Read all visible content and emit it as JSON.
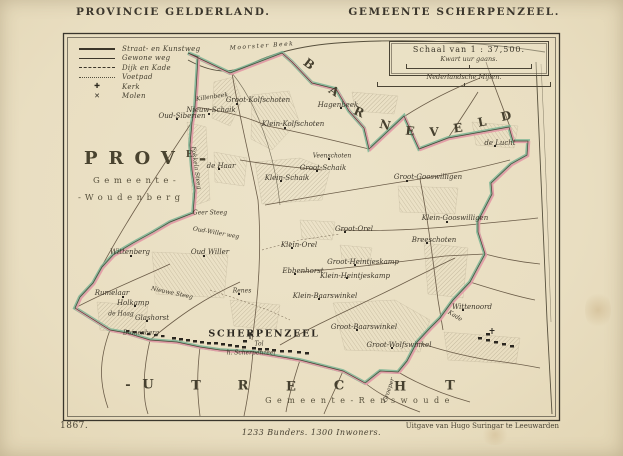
{
  "header": {
    "left_title": "PROVINCIE  GELDERLAND.",
    "right_title": "GEMEENTE  SCHERPENZEEL."
  },
  "legend": {
    "items": [
      {
        "label": "Straat- en Kunstweg"
      },
      {
        "label": "Gewone weg"
      },
      {
        "label": "Dijk en Kade"
      },
      {
        "label": "Voetpad"
      },
      {
        "label": "Kerk",
        "symbol": "✚"
      },
      {
        "label": "Molen",
        "symbol": "✕"
      }
    ],
    "kerk_symbol": "✚",
    "molen_symbol": "✕"
  },
  "scalebox": {
    "title": "Schaal van 1 : 37,500.",
    "kwart": "Kwart uur gaans.",
    "mijlen": "Nederlandsche Mijlen."
  },
  "footer": {
    "year": "1867.",
    "stats": "1233 Bunders. 1300 Inwoners.",
    "publisher": "Uitgave van Hugo Suringar te Leeuwarden"
  },
  "colors": {
    "paper": "#e9dec1",
    "boundary_green": "#7ab494",
    "boundary_pink": "#e59ca6",
    "ink": "#3c362a"
  },
  "map": {
    "province_left": {
      "abbr": "PROV",
      "sup": "E",
      "dash": "-",
      "line2": "Gemeente-",
      "line3": "-Woudenberg"
    },
    "renswoude": "Gemeente-Renswoude",
    "barneveld_letters": [
      {
        "c": "B",
        "x": 309,
        "y": 64,
        "r": 38
      },
      {
        "c": "A",
        "x": 334,
        "y": 91,
        "r": 33
      },
      {
        "c": "R",
        "x": 359,
        "y": 112,
        "r": 24
      },
      {
        "c": "N",
        "x": 385,
        "y": 125,
        "r": 14
      },
      {
        "c": "E",
        "x": 410,
        "y": 131,
        "r": 6
      },
      {
        "c": "V",
        "x": 434,
        "y": 132,
        "r": -2
      },
      {
        "c": "E",
        "x": 458,
        "y": 128,
        "r": -8
      },
      {
        "c": "L",
        "x": 482,
        "y": 122,
        "r": -11
      },
      {
        "c": "D",
        "x": 506,
        "y": 116,
        "r": -13
      }
    ],
    "utrecht_letters": [
      {
        "c": "-",
        "x": 128,
        "y": 385
      },
      {
        "c": "U",
        "x": 148,
        "y": 385
      },
      {
        "c": "T",
        "x": 196,
        "y": 386
      },
      {
        "c": "R",
        "x": 243,
        "y": 386
      },
      {
        "c": "E",
        "x": 291,
        "y": 387
      },
      {
        "c": "C",
        "x": 339,
        "y": 386
      },
      {
        "c": "H",
        "x": 400,
        "y": 387
      },
      {
        "c": "T",
        "x": 450,
        "y": 386
      }
    ],
    "labels": [
      {
        "t": "Moorster Beek",
        "x": 262,
        "y": 46,
        "s": 6,
        "ls": 1.5,
        "r": -4
      },
      {
        "t": "Killenbeek",
        "x": 212,
        "y": 97,
        "s": 6,
        "r": -8
      },
      {
        "t": "Groot-Kolfschoten",
        "x": 258,
        "y": 100
      },
      {
        "t": "Nieuw-Schaik",
        "x": 211,
        "y": 110
      },
      {
        "t": "Klein-Kolfschoten",
        "x": 293,
        "y": 124
      },
      {
        "t": "Oud-Siberien",
        "x": 182,
        "y": 116
      },
      {
        "t": "Hagenbeek",
        "x": 338,
        "y": 105
      },
      {
        "t": "de Lucht",
        "x": 500,
        "y": 143
      },
      {
        "t": "de Haar",
        "x": 221,
        "y": 166
      },
      {
        "t": "Fokkela Steeg",
        "x": 196,
        "y": 168,
        "s": 6,
        "r": 82
      },
      {
        "t": "Veenschoten",
        "x": 332,
        "y": 156,
        "s": 6
      },
      {
        "t": "Groot-Schaik",
        "x": 323,
        "y": 168
      },
      {
        "t": "Klein-Schaik",
        "x": 287,
        "y": 178
      },
      {
        "t": "Groot-Gooswilligen",
        "x": 428,
        "y": 177
      },
      {
        "t": "Klein-Gooswilligen",
        "x": 455,
        "y": 218
      },
      {
        "t": "Breeschoten",
        "x": 434,
        "y": 240
      },
      {
        "t": "Groot-Orel",
        "x": 354,
        "y": 229
      },
      {
        "t": "Klein-Orel",
        "x": 299,
        "y": 245
      },
      {
        "t": "Ebbenhorst",
        "x": 303,
        "y": 271
      },
      {
        "t": "Groot-Heintjeskamp",
        "x": 363,
        "y": 262
      },
      {
        "t": "Klein-Heintjeskamp",
        "x": 355,
        "y": 276
      },
      {
        "t": "Geer Steeg",
        "x": 210,
        "y": 213,
        "s": 6
      },
      {
        "t": "Wittenberg",
        "x": 130,
        "y": 252
      },
      {
        "t": "Oud Willer",
        "x": 210,
        "y": 252
      },
      {
        "t": "Oud-Willer weg",
        "x": 216,
        "y": 233,
        "s": 6,
        "r": 10
      },
      {
        "t": "Nieuwe Steeg",
        "x": 172,
        "y": 293,
        "s": 6,
        "r": 12
      },
      {
        "t": "Renes",
        "x": 242,
        "y": 291,
        "s": 6
      },
      {
        "t": "Rumelaar",
        "x": 112,
        "y": 293
      },
      {
        "t": "Holkamp",
        "x": 133,
        "y": 303
      },
      {
        "t": "de Haag",
        "x": 121,
        "y": 314,
        "s": 6
      },
      {
        "t": "Glashorst",
        "x": 152,
        "y": 318
      },
      {
        "t": "Duinenberg",
        "x": 141,
        "y": 333,
        "s": 6
      },
      {
        "t": "Klein-Baarswinkel",
        "x": 325,
        "y": 296
      },
      {
        "t": "Groot-Baarswinkel",
        "x": 364,
        "y": 327
      },
      {
        "t": "Groot-Wolfswinkel",
        "x": 399,
        "y": 345
      },
      {
        "t": "Wittenoord",
        "x": 472,
        "y": 307
      },
      {
        "t": "Kade",
        "x": 455,
        "y": 316,
        "s": 6,
        "r": 32
      },
      {
        "t": "Groeper",
        "x": 389,
        "y": 390,
        "s": 6,
        "r": -72
      },
      {
        "t": "Tol",
        "x": 259,
        "y": 344,
        "s": 6
      },
      {
        "t": "h. Scherpenzeel",
        "x": 251,
        "y": 353,
        "s": 6
      },
      {
        "t": "SCHERPENZEEL",
        "x": 264,
        "y": 334,
        "cls": "town"
      }
    ]
  }
}
